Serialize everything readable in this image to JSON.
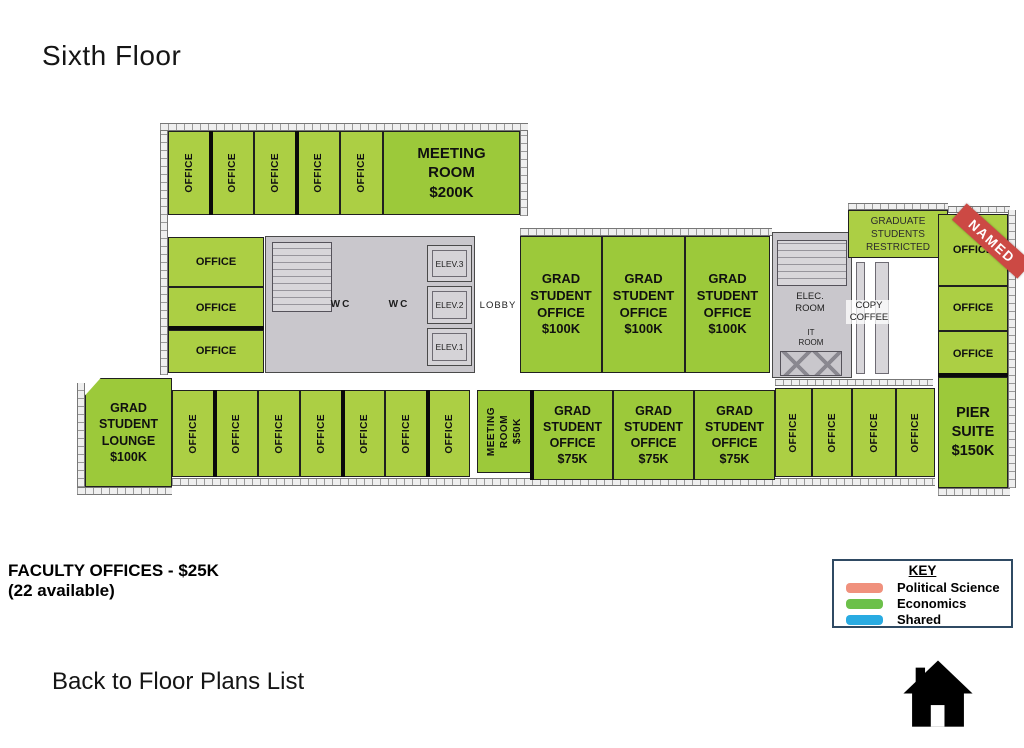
{
  "title": "Sixth Floor",
  "plan": {
    "top_offices": [
      "OFFICE",
      "OFFICE",
      "OFFICE",
      "OFFICE",
      "OFFICE"
    ],
    "meeting_room_200k": "MEETING\nROOM\n$200K",
    "left_offices": [
      "OFFICE",
      "OFFICE",
      "OFFICE"
    ],
    "core": {
      "wc_left": "WC",
      "wc_right": "WC",
      "elev_3": "ELEV.3",
      "elev_2": "ELEV.2",
      "elev_1": "ELEV.1",
      "lobby": "LOBBY"
    },
    "grad_offices_100k": [
      "GRAD\nSTUDENT\nOFFICE\n$100K",
      "GRAD\nSTUDENT\nOFFICE\n$100K",
      "GRAD\nSTUDENT\nOFFICE\n$100K"
    ],
    "elec_room": "ELEC.\nROOM",
    "it_room": "IT\nROOM",
    "copy_coffee": "COPY\nCOFFEE",
    "grad_restricted": "GRADUATE\nSTUDENTS\nRESTRICTED",
    "named_banner": "NAMED",
    "right_offices": [
      "OFFICE",
      "OFFICE",
      "OFFICE"
    ],
    "lounge": "GRAD\nSTUDENT\nLOUNGE\n$100K",
    "bottom_offices_left": [
      "OFFICE",
      "OFFICE",
      "OFFICE",
      "OFFICE",
      "OFFICE",
      "OFFICE",
      "OFFICE"
    ],
    "meeting_room_50k": "MEETING\nROOM\n$50K",
    "grad_offices_75k": [
      "GRAD\nSTUDENT\nOFFICE\n$75K",
      "GRAD\nSTUDENT\nOFFICE\n$75K",
      "GRAD\nSTUDENT\nOFFICE\n$75K"
    ],
    "bottom_offices_right": [
      "OFFICE",
      "OFFICE",
      "OFFICE",
      "OFFICE"
    ],
    "pier_suite": "PIER\nSUITE\n$150K"
  },
  "footer": {
    "faculty_note_line1": "FACULTY OFFICES - $25K",
    "faculty_note_line2": "(22 available)",
    "back_link": "Back to Floor Plans List",
    "home_icon": "home-icon"
  },
  "key": {
    "title": "KEY",
    "items": [
      {
        "label": "Political Science",
        "color": "#f0917d"
      },
      {
        "label": "Economics",
        "color": "#6cc04a"
      },
      {
        "label": "Shared",
        "color": "#29abe2"
      }
    ]
  },
  "colors": {
    "economics_green": "#accf44",
    "economics_green_dark": "#9cc93a",
    "named_red": "#cc4944",
    "core_gray": "#c9c7cc"
  }
}
